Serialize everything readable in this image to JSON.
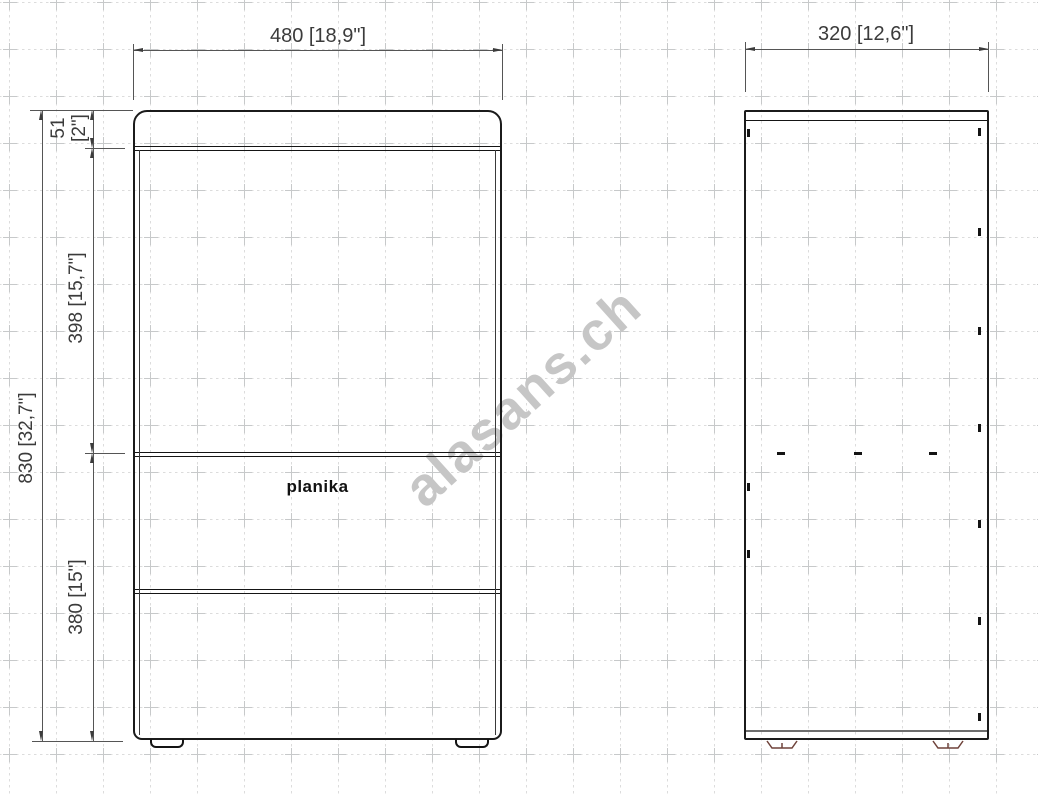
{
  "watermark": {
    "text": "alasans.ch"
  },
  "front_view": {
    "logo": "planika",
    "dimensions": {
      "width": "480 [18,9\"]",
      "total_height": "830 [32,7\"]",
      "top_section_mm": "51",
      "top_section_in": "[2\"]",
      "middle_section": "398 [15,7\"]",
      "bottom_section": "380 [15\"]"
    }
  },
  "side_view": {
    "dimensions": {
      "depth": "320 [12,6\"]"
    }
  },
  "colors": {
    "outline": "#1b1b1b",
    "dimension_line": "#555555",
    "text": "#3b3b3b",
    "grid": "#dcdcdc",
    "watermark": "#c6c6c6",
    "foot_accent": "#6f423a"
  }
}
